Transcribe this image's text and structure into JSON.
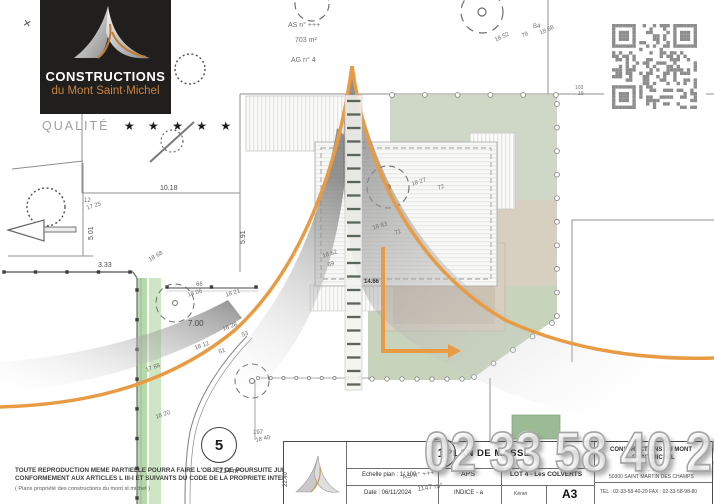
{
  "brand": {
    "name_top": "CONSTRUCTIONS",
    "name_bottom": "du Mont Saint·Michel",
    "quality_label": "QUALITÉ",
    "stars": "★ ★ ★ ★ ★"
  },
  "watermark": {
    "phone": "02 33 58 40 29"
  },
  "title_block": {
    "sheet_number": "1",
    "sheet_title": "PLAN DE MASSE",
    "scale": "Echelle plan : 1/ 100",
    "date": "Date : 06/11/2024",
    "stage": "APS",
    "indice": "INDICE - a",
    "lot": "LOT 4 - Les COLVERTS",
    "author": "Kéran",
    "format": "A3",
    "company": {
      "name_line1": "CONSTRUCTIONS DU MONT",
      "name_line2": "SAINT MICHEL",
      "address_line1": "… Luc",
      "address_line2": "50300 SAINT MARTIN DES CHAMPS",
      "tel_fax": "TEL : 02-33-58-40-29   FAX : 02-33-58-98-80"
    }
  },
  "legal": {
    "line1": "TOUTE REPRODUCTION MEME PARTIELLE POURRA FAIRE L'OBJET DE POURSUITE JUDICIAIRE",
    "line2": "CONFORMEMENT AUX ARTICLES L III-I ET SUIVANTS DU CODE DE LA PROPRIETE INTELECTUELLE",
    "line3": "( Plans propriété des constructions du mont st michel )"
  },
  "plan": {
    "annotations": [
      {
        "t": "✕",
        "x": 24,
        "y": 18,
        "r": 12,
        "s": 10,
        "c": "#555555"
      },
      {
        "t": "AS n° +++",
        "x": 288,
        "y": 22,
        "r": 0,
        "s": 7
      },
      {
        "t": "703 m²",
        "x": 295,
        "y": 37,
        "r": 0,
        "s": 7
      },
      {
        "t": "AG n° 4",
        "x": 291,
        "y": 57,
        "r": 0,
        "s": 7
      },
      {
        "t": "18 52",
        "x": 494,
        "y": 38,
        "r": -25,
        "s": 6
      },
      {
        "t": "78",
        "x": 521,
        "y": 34,
        "r": -25,
        "s": 6
      },
      {
        "t": "B4",
        "x": 533,
        "y": 24,
        "r": 0,
        "s": 6
      },
      {
        "t": "18 68",
        "x": 539,
        "y": 31,
        "r": -25,
        "s": 6
      },
      {
        "t": "103",
        "x": 575,
        "y": 85,
        "r": 0,
        "s": 5
      },
      {
        "t": "19",
        "x": 578,
        "y": 91,
        "r": 0,
        "s": 5
      },
      {
        "t": "12",
        "x": 84,
        "y": 198,
        "r": 0,
        "s": 6
      },
      {
        "t": "17 25",
        "x": 86,
        "y": 206,
        "r": -18,
        "s": 6
      },
      {
        "t": "10.18",
        "x": 160,
        "y": 185,
        "r": 0,
        "s": 7,
        "c": "#4a4a4a"
      },
      {
        "t": "5.01",
        "x": 88,
        "y": 240,
        "r": -90,
        "s": 7,
        "c": "#4a4a4a"
      },
      {
        "t": "5.91",
        "x": 240,
        "y": 244,
        "r": -90,
        "s": 7,
        "c": "#4a4a4a"
      },
      {
        "t": "3.33",
        "x": 98,
        "y": 262,
        "r": 0,
        "s": 7,
        "c": "#4a4a4a"
      },
      {
        "t": "18 68",
        "x": 148,
        "y": 258,
        "r": -30,
        "s": 6
      },
      {
        "t": "66",
        "x": 196,
        "y": 282,
        "r": 0,
        "s": 6
      },
      {
        "t": "18 06",
        "x": 187,
        "y": 293,
        "r": -18,
        "s": 6
      },
      {
        "t": "18 21",
        "x": 225,
        "y": 293,
        "r": -18,
        "s": 6
      },
      {
        "t": "7.00",
        "x": 188,
        "y": 319,
        "r": 0,
        "s": 8,
        "c": "#4a4a4a"
      },
      {
        "t": "18 27",
        "x": 411,
        "y": 182,
        "r": -18,
        "s": 6
      },
      {
        "t": "72",
        "x": 437,
        "y": 186,
        "r": -18,
        "s": 6
      },
      {
        "t": "18 83",
        "x": 372,
        "y": 226,
        "r": -18,
        "s": 6
      },
      {
        "t": "71",
        "x": 394,
        "y": 231,
        "r": -18,
        "s": 6
      },
      {
        "t": "18 62",
        "x": 322,
        "y": 254,
        "r": -18,
        "s": 6
      },
      {
        "t": "69",
        "x": 327,
        "y": 263,
        "r": -18,
        "s": 6
      },
      {
        "t": "14.66",
        "x": 364,
        "y": 279,
        "r": 0,
        "s": 6,
        "c": "#3a3a3a",
        "b": 1
      },
      {
        "t": "18 28",
        "x": 222,
        "y": 327,
        "r": -20,
        "s": 6
      },
      {
        "t": "53",
        "x": 241,
        "y": 333,
        "r": -20,
        "s": 6
      },
      {
        "t": "18 12",
        "x": 194,
        "y": 346,
        "r": -20,
        "s": 6
      },
      {
        "t": "51",
        "x": 218,
        "y": 350,
        "r": -20,
        "s": 6
      },
      {
        "t": "17 88",
        "x": 145,
        "y": 368,
        "r": -20,
        "s": 6
      },
      {
        "t": "18 20",
        "x": 155,
        "y": 415,
        "r": -20,
        "s": 6
      },
      {
        "t": "197",
        "x": 253,
        "y": 430,
        "r": 0,
        "s": 6
      },
      {
        "t": "18 40",
        "x": 255,
        "y": 438,
        "r": -12,
        "s": 6
      },
      {
        "t": "22.40",
        "x": 283,
        "y": 487,
        "r": -90,
        "s": 6,
        "c": "#4a4a4a"
      },
      {
        "t": "214 m²",
        "x": 219,
        "y": 468,
        "r": 0,
        "s": 7,
        "c": "#4a4a4a"
      },
      {
        "t": "AS n° +++",
        "x": 402,
        "y": 474,
        "r": -8,
        "s": 7
      },
      {
        "t": "1147 m²",
        "x": 417,
        "y": 486,
        "r": -8,
        "s": 7
      }
    ],
    "circled_marks": [
      {
        "label": "5",
        "x": 201,
        "y": 427,
        "d": 34,
        "fs": 15
      },
      {
        "label": "1",
        "x": 426,
        "y": 438,
        "d": 28,
        "fs": 12
      }
    ],
    "colors": {
      "accent_orange": "#e89b43",
      "sage_green": "#cfd8c6",
      "hedge_green": "#b4daa8",
      "tan": "#d7cfc0",
      "shadow_gray": "#7d7d7d",
      "qr_gray": "#8d8d8d",
      "logo_bg": "#211f1e",
      "logo_orange": "#c9843f"
    }
  }
}
